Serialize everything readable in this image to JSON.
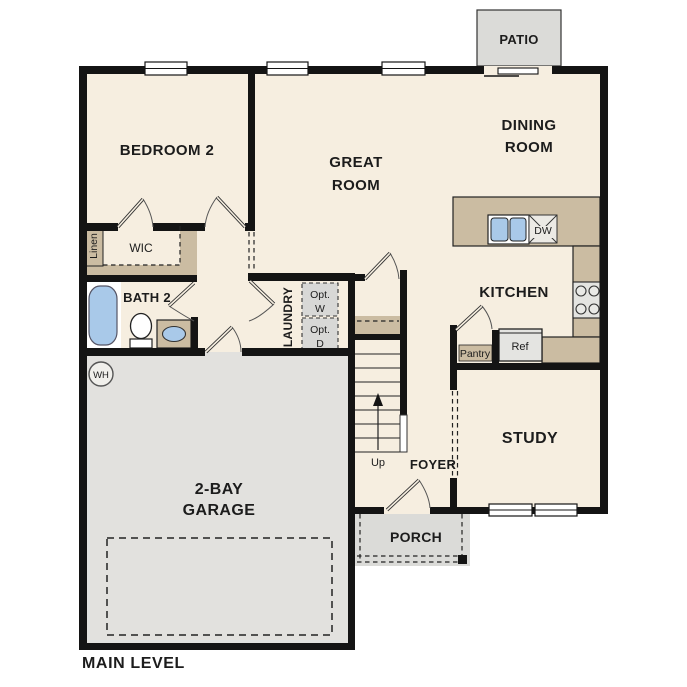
{
  "plan_title": {
    "label": "MAIN LEVEL"
  },
  "palette": {
    "floor": "#f6eee0",
    "wall": "#141414",
    "counter": "#cbbca2",
    "garage_floor": "#e2e1de",
    "patio_floor": "#dbdbd8",
    "porch_floor": "#dbdbd8",
    "opt_box": "#d8d8d6",
    "appliance": "#e4e4e1",
    "fixture_blue": "#a9c9e9"
  },
  "rooms": {
    "patio": {
      "label": "PATIO"
    },
    "bedroom2": {
      "label": "BEDROOM 2"
    },
    "great_room": {
      "line1": "GREAT",
      "line2": "ROOM"
    },
    "dining_room": {
      "line1": "DINING",
      "line2": "ROOM"
    },
    "kitchen": {
      "label": "KITCHEN"
    },
    "study": {
      "label": "STUDY"
    },
    "garage": {
      "line1": "2-BAY",
      "line2": "GARAGE"
    },
    "foyer": {
      "label": "FOYER"
    },
    "porch": {
      "label": "PORCH"
    },
    "laundry": {
      "label": "LAUNDRY"
    },
    "bath2": {
      "label": "BATH 2"
    },
    "wic": {
      "label": "WIC"
    },
    "linen": {
      "label": "Linen"
    }
  },
  "features": {
    "pantry": {
      "label": "Pantry"
    },
    "refrigerator": {
      "label": "Ref"
    },
    "dishwasher": {
      "label": "DW"
    },
    "opt_washer": {
      "line1": "Opt.",
      "line2": "W"
    },
    "opt_dryer": {
      "line1": "Opt.",
      "line2": "D"
    },
    "stairs": {
      "label": "Up"
    },
    "water_heater": {
      "label": "WH"
    }
  }
}
